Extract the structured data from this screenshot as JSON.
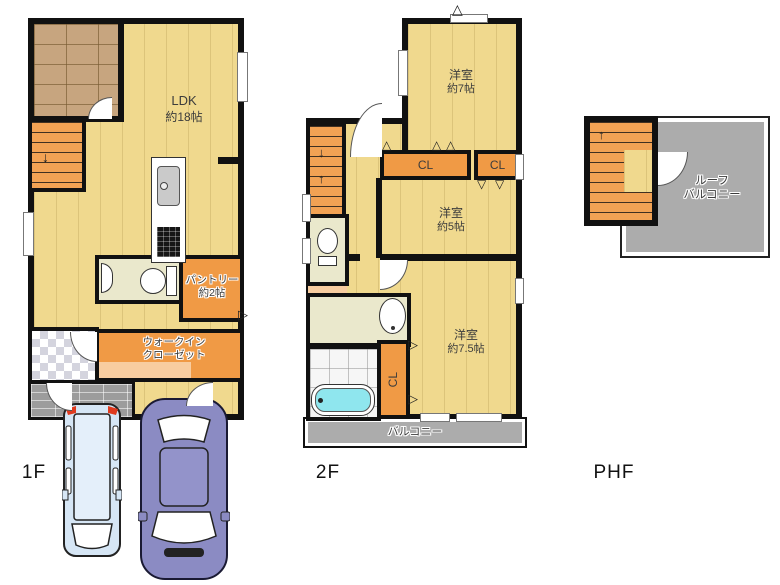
{
  "floors": {
    "f1": {
      "label": "1F",
      "ldk_name": "LDK",
      "ldk_size": "約18帖",
      "pantry_name": "パントリー",
      "pantry_size": "約2帖",
      "wic_line1": "ウォークイン",
      "wic_line2": "クローゼット"
    },
    "f2": {
      "label": "2F",
      "room7_name": "洋室",
      "room7_size": "約7帖",
      "room5_name": "洋室",
      "room5_size": "約5帖",
      "room75_name": "洋室",
      "room75_size": "約7.5帖",
      "cl1": "CL",
      "cl2": "CL",
      "cl3": "CL",
      "balcony": "バルコニー"
    },
    "phf": {
      "label": "PHF",
      "roof_line1": "ルーフ",
      "roof_line2": "バルコニー"
    }
  },
  "icons": {
    "tri_up": "△",
    "tri_down": "▽",
    "tri_right": "▷",
    "arrow_down": "↓",
    "arrow_up": "↑"
  },
  "colors": {
    "wall": "#111111",
    "floor_wood": "#F0D98E",
    "room_orange": "#F09A45",
    "stairs_orange": "#F2A254",
    "sanitary_cream": "#EAE8CC",
    "terrace_brick": "#C7A57F",
    "porch_gray": "#9C9C9C",
    "balcony_gray": "#ACACAC",
    "bathtub_cyan": "#8FE6EE",
    "car_blue": "#D6E6F5",
    "car_purple": "#8B8BC3"
  }
}
